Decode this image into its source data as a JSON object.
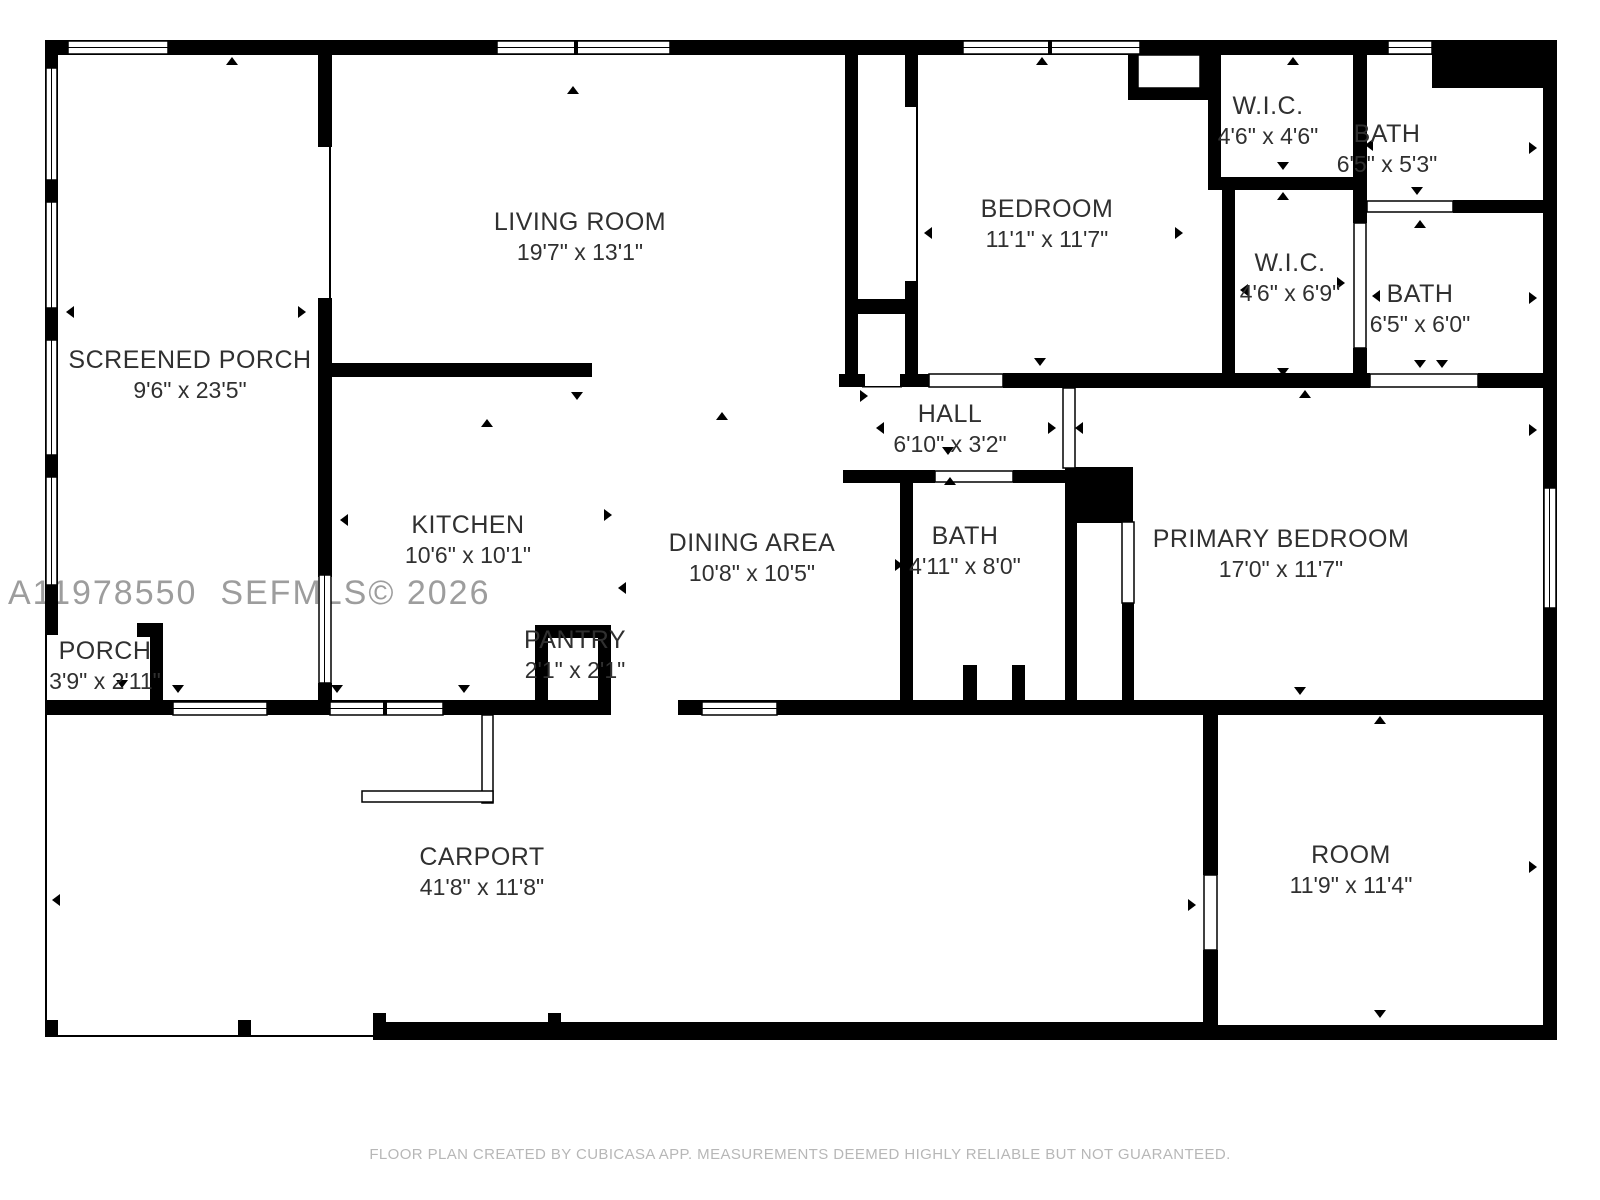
{
  "watermark": "A11978550  SEFMLS© 2026",
  "footer": "FLOOR PLAN CREATED BY CUBICASA APP. MEASUREMENTS DEEMED HIGHLY RELIABLE BUT NOT GUARANTEED.",
  "colors": {
    "wall": "#000000",
    "floor": "#ffffff",
    "label_text": "#303030",
    "watermark_text": "#9d9d9d",
    "footer_text": "#b7b7b7"
  },
  "rooms": [
    {
      "id": "screened-porch",
      "name": "SCREENED PORCH",
      "dims": "9'6\" x 23'5\""
    },
    {
      "id": "living-room",
      "name": "LIVING ROOM",
      "dims": "19'7\" x 13'1\""
    },
    {
      "id": "bedroom",
      "name": "BEDROOM",
      "dims": "11'1\" x 11'7\""
    },
    {
      "id": "wic-1",
      "name": "W.I.C.",
      "dims": "4'6\" x 4'6\""
    },
    {
      "id": "bath-1",
      "name": "BATH",
      "dims": "6'5\" x 5'3\""
    },
    {
      "id": "wic-2",
      "name": "W.I.C.",
      "dims": "4'6\" x 6'9\""
    },
    {
      "id": "bath-2",
      "name": "BATH",
      "dims": "6'5\" x 6'0\""
    },
    {
      "id": "hall",
      "name": "HALL",
      "dims": "6'10\" x 3'2\""
    },
    {
      "id": "kitchen",
      "name": "KITCHEN",
      "dims": "10'6\" x 10'1\""
    },
    {
      "id": "dining-area",
      "name": "DINING AREA",
      "dims": "10'8\" x 10'5\""
    },
    {
      "id": "bath-3",
      "name": "BATH",
      "dims": "4'11\" x 8'0\""
    },
    {
      "id": "primary-bedroom",
      "name": "PRIMARY BEDROOM",
      "dims": "17'0\" x 11'7\""
    },
    {
      "id": "porch",
      "name": "PORCH",
      "dims": "3'9\" x 2'11\""
    },
    {
      "id": "pantry",
      "name": "PANTRY",
      "dims": "2'1\" x 2'1\""
    },
    {
      "id": "carport",
      "name": "CARPORT",
      "dims": "41'8\" x 11'8\""
    },
    {
      "id": "room",
      "name": "ROOM",
      "dims": "11'9\" x 11'4\""
    }
  ]
}
